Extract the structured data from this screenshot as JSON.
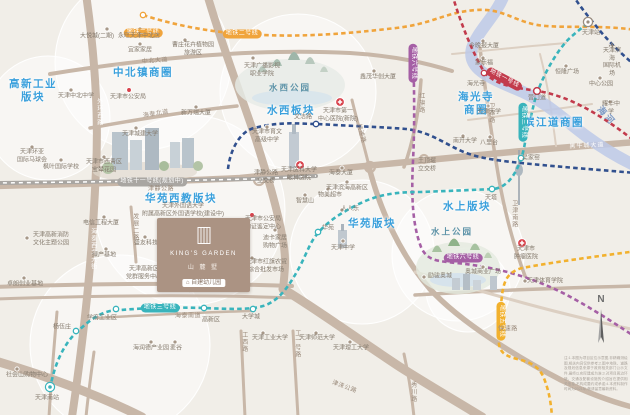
{
  "colors": {
    "l1": "#c23b4c",
    "l2": "#f0a43c",
    "l3": "#39b4bc",
    "l5": "#f2b12e",
    "l6": "#a55fa5",
    "l9": "#31508e",
    "l11": "#a9a6a2",
    "road": "#c8b7a8",
    "roadMinor": "#dccfc2",
    "river": "#bdc9e7",
    "accent": "#3aa0dc"
  },
  "compass": "N",
  "project": {
    "name_en": "KING'S GARDEN",
    "name_cn": "山 麓 墅",
    "kindergarten": "自建幼儿园"
  },
  "disclaimer": "注:1.本图为项目区位示意图,非精确测绘图,相关内容仅供参考;2.图中地铁、道路及规划信息来源于政府相关部门公示文件,最终以实际建成为准;3.对项目周边环境、交通及配套设施的介绍旨在提供相关信息,不构成要约或承诺;4.本资料制作时间为2021年,敬请留意最新资料。",
  "bubbles": [
    [
      143,
      62,
      88
    ],
    [
      48,
      118,
      62
    ],
    [
      298,
      92,
      78
    ],
    [
      190,
      210,
      95
    ],
    [
      362,
      252,
      72
    ],
    [
      458,
      255,
      66
    ],
    [
      120,
      345,
      90
    ],
    [
      468,
      290,
      42
    ]
  ],
  "river": {
    "d": "M 505,-8 C 498,14 478,30 472,48 C 467,67 486,77 516,89 C 546,101 563,119 586,136 C 605,150 621,159 638,167",
    "w": 12
  },
  "roads": [
    {
      "d": "M 86,-6 C 94,50 99,110 96,170 C 93,235 89,300 72,417",
      "w": 8,
      "c": "road"
    },
    {
      "d": "M 50,74 C 150,58 258,48 350,53 C 396,56 426,63 452,71",
      "w": 4,
      "c": "road"
    },
    {
      "d": "M 207,-6 C 225,55 243,100 256,140 C 268,178 277,207 283,240 C 287,262 284,276 283,290",
      "w": 8,
      "c": "road"
    },
    {
      "d": "M -6,186 C 80,184 160,182 240,178 C 320,171 400,163 480,155 C 540,149 586,146 636,142",
      "w": 6.5,
      "c": "road"
    },
    {
      "d": "M 369,167 C 380,210 400,254 430,289 C 460,322 520,359 561,380 C 590,394 616,403 636,408",
      "w": 5.5,
      "c": "road"
    },
    {
      "d": "M -6,287 C 80,284 180,282 292,286",
      "w": 4,
      "c": "road"
    },
    {
      "d": "M -6,299 C 90,296 190,294 296,298",
      "w": 3,
      "c": "road"
    },
    {
      "d": "M -8,360 C 40,374 92,392 142,417",
      "w": 9,
      "c": "road"
    },
    {
      "d": "M 283,289 C 315,308 356,338 400,367 C 430,386 456,401 482,417",
      "w": 9,
      "c": "road"
    },
    {
      "d": "M 415,295 C 480,291 560,288 636,286",
      "w": 3.5,
      "c": "road"
    },
    {
      "d": "M 415,272 C 490,294 562,315 636,330",
      "w": 3,
      "c": "minor"
    },
    {
      "d": "M 480,48 C 486,95 492,140 500,185 C 507,222 516,252 525,276",
      "w": 3.5,
      "c": "road"
    },
    {
      "d": "M 421,80 C 419,110 414,140 404,167",
      "w": 3.5,
      "c": "road"
    },
    {
      "d": "M 90,128 C 140,119 190,111 237,106",
      "w": 3.5,
      "c": "road"
    },
    {
      "d": "M 241,331 L 245,417",
      "w": 3,
      "c": "road"
    },
    {
      "d": "M 293,331 L 298,417",
      "w": 3,
      "c": "road"
    },
    {
      "d": "M 404,354 C 409,377 412,397 414,417",
      "w": 3,
      "c": "road"
    },
    {
      "d": "M 131,207 C 133,228 135,247 136,262",
      "w": 3,
      "c": "road"
    },
    {
      "d": "M 57,312 C 54,347 51,382 49,417",
      "w": 3,
      "c": "road"
    },
    {
      "d": "M 94,352 C 91,374 88,396 86,417",
      "w": 3,
      "c": "road"
    },
    {
      "d": "M 95,318 C 150,315 205,312 252,311",
      "w": 2.5,
      "c": "road"
    },
    {
      "d": "M 352,100 C 358,125 364,145 369,166",
      "w": 3,
      "c": "road"
    },
    {
      "d": "M 540,54 C 548,85 552,115 556,146",
      "w": 2,
      "c": "minor"
    },
    {
      "d": "M 468,120 C 510,115 550,110 592,104",
      "w": 2,
      "c": "minor"
    },
    {
      "d": "M 452,54 C 492,50 530,46 566,43",
      "w": 2,
      "c": "minor"
    }
  ],
  "loops": [
    [
      259,
      180,
      5
    ],
    [
      370,
      167,
      5
    ],
    [
      424,
      159,
      4
    ]
  ],
  "metro_lines": [
    {
      "id": "line-11-planned",
      "c": "l11",
      "planned": true,
      "d": "M -5,183 C 80,182 170,181 250,179 C 274,178 296,177 316,176"
    },
    {
      "id": "line-2",
      "c": "l2",
      "d": "M 143,15 C 180,27 222,34 262,35 C 312,37 352,33 396,28 C 432,24 446,12 476,10 C 506,8 516,24 546,26 C 572,28 602,25 636,30"
    },
    {
      "id": "line-1",
      "c": "l1",
      "d": "M 452,-6 C 461,24 471,49 484,72 C 496,86 518,88 538,91 C 574,97 606,119 636,142"
    },
    {
      "id": "line-9a",
      "c": "l9",
      "d": "M 228,169 C 230,151 239,132 254,128 C 282,121 300,124 317,124 C 352,126 382,127 406,129 C 426,131 441,141 457,149 C 477,159 502,161 531,164 C 562,167 600,170 636,173"
    },
    {
      "id": "line-9b",
      "c": "l9",
      "d": "M 572,-6 C 581,8 591,20 601,32 C 613,46 625,57 638,68"
    },
    {
      "id": "line-6",
      "c": "l6",
      "d": "M 413,44 C 414,82 415,122 413,161 C 411,200 413,226 421,247 C 427,261 438,261 456,263 C 500,267 541,280 576,300 C 601,314 620,327 637,338"
    },
    {
      "id": "line-5",
      "c": "l5",
      "d": "M 637,251 C 600,256 560,261 522,268 C 508,272 504,280 502,295 C 500,315 498,332 499,344 C 500,352 505,356 517,359 C 530,362 538,366 543,376 C 549,390 551,403 552,417"
    },
    {
      "id": "line-3",
      "c": "l3",
      "d": "M 50,389 C 54,366 63,344 78,331 C 90,320 98,314 110,311 C 140,308 170,307 204,308 C 228,309 250,310 263,306 C 280,301 290,284 299,268 C 307,253 310,242 318,233 C 330,219 346,210 363,202 C 383,193 402,192 421,192 C 446,191 472,190 493,189 C 507,188 516,174 521,159 C 526,144 525,136 529,124 C 533,110 534,100 538,91 C 545,71 560,46 572,36 C 579,30 584,26 589,23"
    }
  ],
  "stations": [
    {
      "x": 143,
      "y": 15,
      "c": "l2"
    },
    {
      "x": 484,
      "y": 73,
      "c": "l1"
    },
    {
      "x": 537,
      "y": 91,
      "c": "l1",
      "big": 1
    },
    {
      "x": 316,
      "y": 124,
      "c": "l9"
    },
    {
      "x": 318,
      "y": 232,
      "c": "l3"
    },
    {
      "x": 492,
      "y": 189,
      "c": "l3"
    },
    {
      "x": 521,
      "y": 158,
      "c": "l3"
    },
    {
      "x": 76,
      "y": 331,
      "c": "l3"
    },
    {
      "x": 116,
      "y": 309,
      "c": "l3"
    },
    {
      "x": 204,
      "y": 308,
      "c": "l3"
    },
    {
      "x": 253,
      "y": 309,
      "c": "l3"
    },
    {
      "x": 50,
      "y": 387,
      "c": "l3",
      "terminus": 1
    },
    {
      "x": 588,
      "y": 22,
      "c": "l3",
      "hub": 1
    }
  ],
  "points": [
    {
      "k": "dot",
      "x": 107,
      "y": 29
    },
    {
      "k": "dot",
      "x": 140,
      "y": 29
    },
    {
      "k": "dot",
      "x": 140,
      "y": 44
    },
    {
      "k": "dot",
      "x": 185,
      "y": 40
    },
    {
      "k": "dot",
      "x": 71,
      "y": 90
    },
    {
      "k": "dot",
      "x": 196,
      "y": 107
    },
    {
      "k": "dot",
      "x": 136,
      "y": 128
    },
    {
      "k": "dot",
      "x": 32,
      "y": 147
    },
    {
      "k": "dot",
      "x": 61,
      "y": 160
    },
    {
      "k": "dot",
      "x": 104,
      "y": 157
    },
    {
      "k": "dot",
      "x": 253,
      "y": 58
    },
    {
      "k": "dot",
      "x": 374,
      "y": 71
    },
    {
      "k": "dot",
      "x": 267,
      "y": 127
    },
    {
      "k": "dot",
      "x": 483,
      "y": 41
    },
    {
      "k": "dot",
      "x": 483,
      "y": 58
    },
    {
      "k": "dot",
      "x": 566,
      "y": 66
    },
    {
      "k": "dot",
      "x": 600,
      "y": 78
    },
    {
      "k": "dot",
      "x": 610,
      "y": 102
    },
    {
      "k": "dot",
      "x": 488,
      "y": 106
    },
    {
      "k": "dot",
      "x": 463,
      "y": 136
    },
    {
      "k": "dot",
      "x": 490,
      "y": 137
    },
    {
      "k": "dot",
      "x": 104,
      "y": 217
    },
    {
      "k": "dot",
      "x": 27,
      "y": 238
    },
    {
      "k": "dot",
      "x": 106,
      "y": 249
    },
    {
      "k": "dot",
      "x": 145,
      "y": 237
    },
    {
      "k": "dot",
      "x": 275,
      "y": 230
    },
    {
      "k": "dot",
      "x": 252,
      "y": 258
    },
    {
      "k": "dot",
      "x": 305,
      "y": 195
    },
    {
      "k": "dot",
      "x": 328,
      "y": 189
    },
    {
      "k": "dot",
      "x": 342,
      "y": 210
    },
    {
      "k": "dot",
      "x": 342,
      "y": 168
    },
    {
      "k": "dot",
      "x": 347,
      "y": 182
    },
    {
      "k": "dot",
      "x": 525,
      "y": 281
    },
    {
      "k": "dot",
      "x": 483,
      "y": 267
    },
    {
      "k": "dot",
      "x": 424,
      "y": 277
    },
    {
      "k": "dot",
      "x": 24,
      "y": 278
    },
    {
      "k": "dot",
      "x": 17,
      "y": 369
    },
    {
      "k": "dot",
      "x": 151,
      "y": 342
    },
    {
      "k": "dot",
      "x": 175,
      "y": 342
    },
    {
      "k": "dot",
      "x": 263,
      "y": 333
    },
    {
      "k": "dot",
      "x": 316,
      "y": 333
    },
    {
      "k": "dot",
      "x": 350,
      "y": 342
    },
    {
      "k": "dot",
      "x": 343,
      "y": 241
    },
    {
      "k": "red",
      "x": 129,
      "y": 90
    },
    {
      "k": "red",
      "x": 252,
      "y": 215
    },
    {
      "k": "cross",
      "x": 340,
      "y": 102
    },
    {
      "k": "cross",
      "x": 300,
      "y": 165
    },
    {
      "k": "cross",
      "x": 522,
      "y": 243
    },
    {
      "k": "plane",
      "x": 612,
      "y": 49
    }
  ],
  "labels": [
    {
      "t": "高新工业\n版块",
      "x": 33,
      "y": 91,
      "c": "d"
    },
    {
      "t": "中北镇商圈",
      "x": 143,
      "y": 73,
      "c": "d"
    },
    {
      "t": "水西板块",
      "x": 291,
      "y": 111,
      "c": "d"
    },
    {
      "t": "海光寺\n商圈",
      "x": 476,
      "y": 104,
      "c": "d"
    },
    {
      "t": "滨江道商圈",
      "x": 554,
      "y": 123,
      "c": "d"
    },
    {
      "t": "华苑西教版块",
      "x": 181,
      "y": 199,
      "c": "d"
    },
    {
      "t": "华苑版块",
      "x": 372,
      "y": 224,
      "c": "d"
    },
    {
      "t": "水上版块",
      "x": 467,
      "y": 207,
      "c": "d"
    },
    {
      "t": "水西公园",
      "x": 290,
      "y": 88,
      "c": "park"
    },
    {
      "t": "水上公园",
      "x": 452,
      "y": 232,
      "c": "park"
    },
    {
      "t": "海河",
      "x": 606,
      "y": 116,
      "c": "riv",
      "r": 48
    },
    {
      "t": "地铁二号线",
      "x": 143,
      "y": 33,
      "c": "pill",
      "bg": "l2"
    },
    {
      "t": "地铁二号线",
      "x": 242,
      "y": 34,
      "c": "pill",
      "bg": "l2"
    },
    {
      "t": "地铁一号线",
      "x": 504,
      "y": 79,
      "c": "pill",
      "bg": "l1",
      "r": 28
    },
    {
      "t": "地铁三号线",
      "x": 160,
      "y": 308,
      "c": "pill",
      "bg": "l3"
    },
    {
      "t": "地铁三号线",
      "x": 523,
      "y": 122,
      "c": "pill",
      "bg": "l3",
      "r": 90
    },
    {
      "t": "地铁六号线",
      "x": 413,
      "y": 63,
      "c": "pill",
      "bg": "l6",
      "r": 90
    },
    {
      "t": "地铁六号线",
      "x": 463,
      "y": 258,
      "c": "pill",
      "bg": "l6"
    },
    {
      "t": "地铁五号线",
      "x": 501,
      "y": 321,
      "c": "pill",
      "bg": "l5",
      "r": 90
    },
    {
      "t": "地铁十一号线(规划中)",
      "x": 152,
      "y": 182,
      "c": "pill",
      "bg": "l11"
    },
    {
      "t": "中北大道",
      "x": 155,
      "y": 62,
      "c": "road",
      "r": -4
    },
    {
      "t": "海泰北道",
      "x": 156,
      "y": 115,
      "c": "road",
      "r": -9
    },
    {
      "t": "外环西路",
      "x": 98,
      "y": 112,
      "c": "roadw v"
    },
    {
      "t": "津静公路",
      "x": 161,
      "y": 190,
      "c": "road"
    },
    {
      "t": "快速路",
      "x": 360,
      "y": 134,
      "c": "road",
      "r": 75
    },
    {
      "t": "快速路",
      "x": 508,
      "y": 330,
      "c": "road"
    },
    {
      "t": "黑牛城大道",
      "x": 587,
      "y": 147,
      "c": "roadw",
      "r": -3
    },
    {
      "t": "卫津路",
      "x": 490,
      "y": 113,
      "c": "road v"
    },
    {
      "t": "卫津南路",
      "x": 513,
      "y": 214,
      "c": "road v"
    },
    {
      "t": "红旗路",
      "x": 420,
      "y": 103,
      "c": "road v"
    },
    {
      "t": "发展二路",
      "x": 134,
      "y": 227,
      "c": "road v"
    },
    {
      "t": "发展三路",
      "x": 180,
      "y": 291,
      "c": "road"
    },
    {
      "t": "海泰南道",
      "x": 188,
      "y": 317,
      "c": "road"
    },
    {
      "t": "海泰西北大街",
      "x": 92,
      "y": 249,
      "c": "roadw v"
    },
    {
      "t": "工西路",
      "x": 243,
      "y": 342,
      "c": "road v"
    },
    {
      "t": "工一号路",
      "x": 296,
      "y": 344,
      "c": "road v"
    },
    {
      "t": "津涞公路",
      "x": 344,
      "y": 388,
      "c": "road",
      "r": 20
    },
    {
      "t": "秀川路",
      "x": 412,
      "y": 392,
      "c": "road v"
    },
    {
      "t": "海光寺",
      "x": 476,
      "y": 85,
      "c": "st"
    },
    {
      "t": "营口道",
      "x": 537,
      "y": 99,
      "c": "st"
    },
    {
      "t": "文洁路",
      "x": 303,
      "y": 118,
      "c": "st"
    },
    {
      "t": "华苑",
      "x": 328,
      "y": 229,
      "c": "st"
    },
    {
      "t": "天塔",
      "x": 491,
      "y": 199,
      "c": "st"
    },
    {
      "t": "吴家窑",
      "x": 531,
      "y": 159,
      "c": "st"
    },
    {
      "t": "杨伍庄",
      "x": 62,
      "y": 328,
      "c": "st"
    },
    {
      "t": "学府工业区",
      "x": 102,
      "y": 319,
      "c": "st"
    },
    {
      "t": "高新区",
      "x": 211,
      "y": 321,
      "c": "st"
    },
    {
      "t": "大学城",
      "x": 251,
      "y": 318,
      "c": "st"
    },
    {
      "t": "天津南站",
      "x": 47,
      "y": 399,
      "c": "st"
    },
    {
      "t": "天津站",
      "x": 591,
      "y": 34,
      "c": "st"
    },
    {
      "t": "大悦城(二期)",
      "x": 97,
      "y": 37,
      "c": "poi"
    },
    {
      "t": "永旺天津中北店",
      "x": 139,
      "y": 37,
      "c": "poi"
    },
    {
      "t": "宜家家居",
      "x": 140,
      "y": 51,
      "c": "poi"
    },
    {
      "t": "曹庄花卉植物园\n旅游区",
      "x": 193,
      "y": 50,
      "c": "poi"
    },
    {
      "t": "天津中北中学",
      "x": 76,
      "y": 97,
      "c": "poi"
    },
    {
      "t": "天津市公安局",
      "x": 128,
      "y": 98,
      "c": "poi"
    },
    {
      "t": "新万瑞大厦",
      "x": 196,
      "y": 114,
      "c": "poi"
    },
    {
      "t": "天津城建大学",
      "x": 140,
      "y": 135,
      "c": "poi"
    },
    {
      "t": "天津环亚\n国际马球会",
      "x": 32,
      "y": 157,
      "c": "poi"
    },
    {
      "t": "枫叶国际学校",
      "x": 61,
      "y": 168,
      "c": "poi"
    },
    {
      "t": "天津市西青区\n宝辇花园",
      "x": 104,
      "y": 167,
      "c": "poi"
    },
    {
      "t": "天津广播影视\n职业学院",
      "x": 262,
      "y": 71,
      "c": "poi"
    },
    {
      "t": "鑫茂华创大厦",
      "x": 378,
      "y": 78,
      "c": "poi"
    },
    {
      "t": "天津市第一\n中心医院(新院)",
      "x": 338,
      "y": 116,
      "c": "poi"
    },
    {
      "t": "天津市育文\n高级中学",
      "x": 267,
      "y": 137,
      "c": "poi"
    },
    {
      "t": "今晚报大厦",
      "x": 484,
      "y": 47,
      "c": "poi"
    },
    {
      "t": "家乐福",
      "x": 484,
      "y": 64,
      "c": "poi"
    },
    {
      "t": "恒隆广场",
      "x": 567,
      "y": 73,
      "c": "poi"
    },
    {
      "t": "中心公园",
      "x": 601,
      "y": 85,
      "c": "poi"
    },
    {
      "t": "耀华中学",
      "x": 611,
      "y": 109,
      "c": "poi"
    },
    {
      "t": "天津大学",
      "x": 489,
      "y": 113,
      "c": "poi"
    },
    {
      "t": "南开大学",
      "x": 465,
      "y": 142,
      "c": "poi"
    },
    {
      "t": "八里台",
      "x": 489,
      "y": 144,
      "c": "poi"
    },
    {
      "t": "天津滨海\n国际机场",
      "x": 612,
      "y": 63,
      "c": "poi"
    },
    {
      "t": "天津外国语大学\n附属高新区外国语学校(建设中)",
      "x": 183,
      "y": 211,
      "c": "poi"
    },
    {
      "t": "电信工程大厦",
      "x": 101,
      "y": 224,
      "c": "poi"
    },
    {
      "t": "天津高新消防\n文化主题公园",
      "x": 51,
      "y": 240,
      "c": "poi"
    },
    {
      "t": "绿产基地",
      "x": 104,
      "y": 256,
      "c": "poi"
    },
    {
      "t": "盛友科技",
      "x": 146,
      "y": 244,
      "c": "poi"
    },
    {
      "t": "天津市公安局\n物证鉴定中心",
      "x": 263,
      "y": 224,
      "c": "poi"
    },
    {
      "t": "迪卡家居\n购物广场",
      "x": 275,
      "y": 243,
      "c": "poi"
    },
    {
      "t": "天津市红旗农贸\n综合批发市场",
      "x": 266,
      "y": 267,
      "c": "poi"
    },
    {
      "t": "智慧山",
      "x": 305,
      "y": 202,
      "c": "poi"
    },
    {
      "t": "物美超市",
      "x": 330,
      "y": 196,
      "c": "poi"
    },
    {
      "t": "人人乐",
      "x": 350,
      "y": 210,
      "c": "poi"
    },
    {
      "t": "天津中学",
      "x": 343,
      "y": 249,
      "c": "poi"
    },
    {
      "t": "津静公路\n立交桥",
      "x": 266,
      "y": 178,
      "c": "poi"
    },
    {
      "t": "王顶堤\n立交桥",
      "x": 427,
      "y": 166,
      "c": "poi"
    },
    {
      "t": "天津医科大学\n眼科医院",
      "x": 299,
      "y": 175,
      "c": "poi"
    },
    {
      "t": "海泰大厦",
      "x": 341,
      "y": 174,
      "c": "poi"
    },
    {
      "t": "天津滨海高新区",
      "x": 347,
      "y": 189,
      "c": "poi"
    },
    {
      "t": "天津市\n肿瘤医院",
      "x": 526,
      "y": 254,
      "c": "poi"
    },
    {
      "t": "天津体育学院",
      "x": 545,
      "y": 282,
      "c": "poi"
    },
    {
      "t": "奥城商业广场",
      "x": 483,
      "y": 273,
      "c": "poi"
    },
    {
      "t": "励骏奥城",
      "x": 440,
      "y": 277,
      "c": "poi"
    },
    {
      "t": "天津高新区\n党群服务中心",
      "x": 144,
      "y": 274,
      "c": "poi"
    },
    {
      "t": "卓朗创业基地",
      "x": 25,
      "y": 285,
      "c": "poi"
    },
    {
      "t": "社会山购物中心",
      "x": 27,
      "y": 376,
      "c": "poi"
    },
    {
      "t": "海润德产业园",
      "x": 151,
      "y": 349,
      "c": "poi"
    },
    {
      "t": "麦谷",
      "x": 176,
      "y": 349,
      "c": "poi"
    },
    {
      "t": "天津工业大学",
      "x": 270,
      "y": 339,
      "c": "poi"
    },
    {
      "t": "天津师范大学",
      "x": 317,
      "y": 339,
      "c": "poi"
    },
    {
      "t": "天津理工大学",
      "x": 351,
      "y": 349,
      "c": "poi"
    }
  ]
}
